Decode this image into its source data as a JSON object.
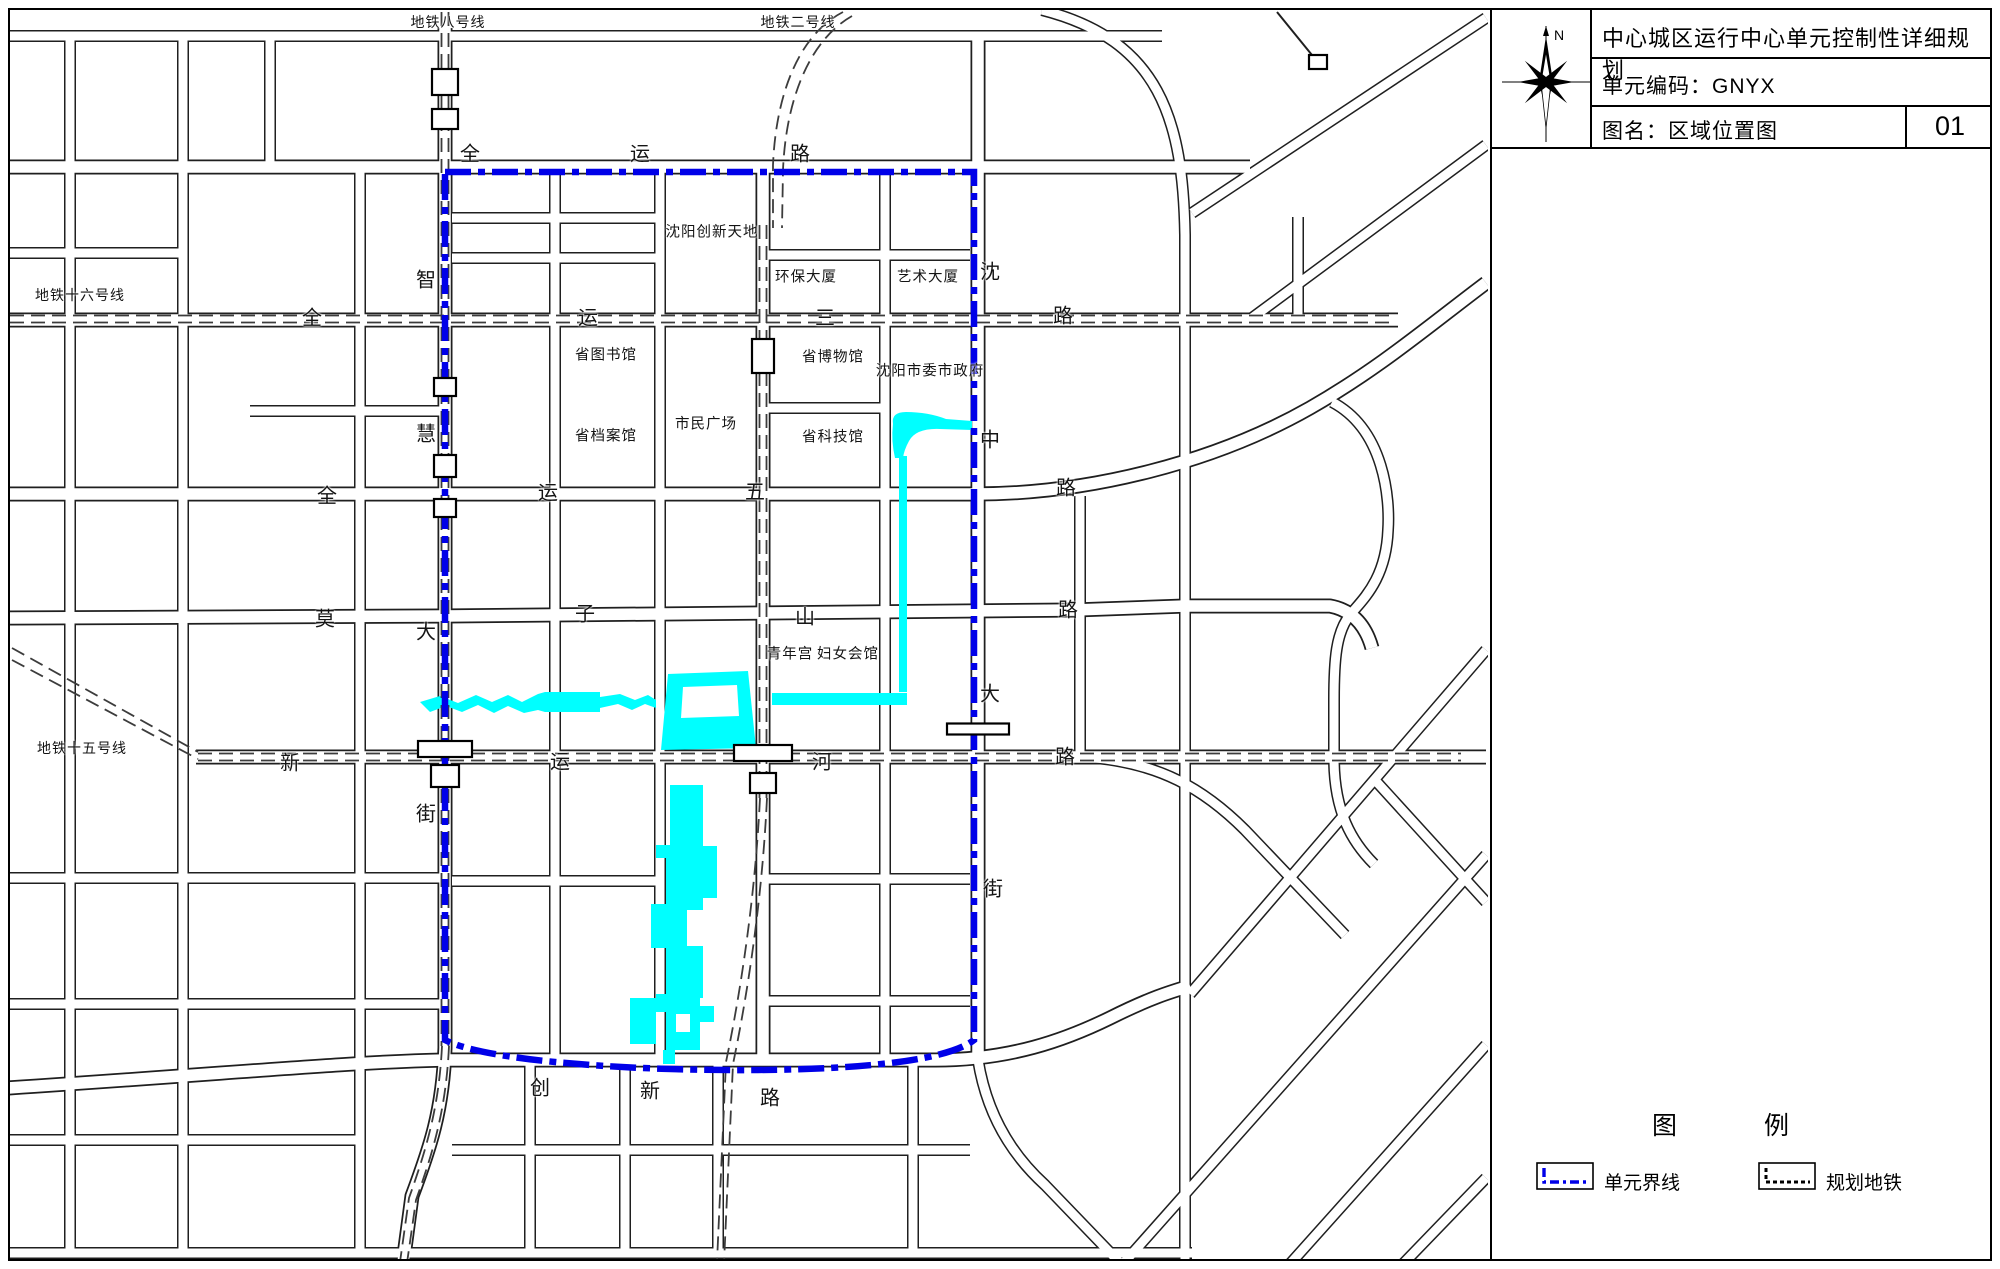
{
  "title_block": {
    "project_title": "中心城区运行中心单元控制性详细规划",
    "unit_code_line": "单元编码：GNYX",
    "map_name_line": "图名：区域位置图",
    "sheet_number": "01",
    "north_label": "N"
  },
  "legend": {
    "title_left": "图",
    "title_right": "例",
    "items": [
      {
        "label": "单元界线",
        "type": "unit-boundary"
      },
      {
        "label": "规划地铁",
        "type": "planned-metro"
      }
    ]
  },
  "colors": {
    "boundary_blue": "#0000E8",
    "water_cyan": "#00FFFF",
    "road_line": "#1f1f1f",
    "metro_dash": "#3c3c3c"
  },
  "map": {
    "metro_labels": [
      {
        "t": "地铁八号线",
        "x": 448,
        "y": 22
      },
      {
        "t": "地铁二号线",
        "x": 798,
        "y": 22
      },
      {
        "t": "地铁十六号线",
        "x": 80,
        "y": 295
      },
      {
        "t": "地铁十五号线",
        "x": 82,
        "y": 748
      }
    ],
    "road_chars": [
      {
        "t": "全",
        "x": 470,
        "y": 152
      },
      {
        "t": "运",
        "x": 640,
        "y": 152
      },
      {
        "t": "路",
        "x": 800,
        "y": 152
      },
      {
        "t": "全",
        "x": 312,
        "y": 316
      },
      {
        "t": "运",
        "x": 588,
        "y": 316
      },
      {
        "t": "三",
        "x": 825,
        "y": 316
      },
      {
        "t": "路",
        "x": 1063,
        "y": 314
      },
      {
        "t": "全",
        "x": 327,
        "y": 494
      },
      {
        "t": "运",
        "x": 548,
        "y": 491
      },
      {
        "t": "五",
        "x": 755,
        "y": 490
      },
      {
        "t": "路",
        "x": 1066,
        "y": 486
      },
      {
        "t": "莫",
        "x": 325,
        "y": 617
      },
      {
        "t": "子",
        "x": 585,
        "y": 612
      },
      {
        "t": "山",
        "x": 805,
        "y": 615
      },
      {
        "t": "路",
        "x": 1068,
        "y": 608
      },
      {
        "t": "新",
        "x": 290,
        "y": 761
      },
      {
        "t": "运",
        "x": 560,
        "y": 760
      },
      {
        "t": "河",
        "x": 822,
        "y": 760
      },
      {
        "t": "路",
        "x": 1065,
        "y": 755
      },
      {
        "t": "创",
        "x": 540,
        "y": 1086
      },
      {
        "t": "新",
        "x": 650,
        "y": 1089
      },
      {
        "t": "路",
        "x": 770,
        "y": 1096
      },
      {
        "t": "智",
        "x": 426,
        "y": 278
      },
      {
        "t": "慧",
        "x": 426,
        "y": 432
      },
      {
        "t": "大",
        "x": 426,
        "y": 630
      },
      {
        "t": "街",
        "x": 426,
        "y": 812
      },
      {
        "t": "沈",
        "x": 990,
        "y": 270
      },
      {
        "t": "中",
        "x": 990,
        "y": 438
      },
      {
        "t": "大",
        "x": 990,
        "y": 692
      },
      {
        "t": "街",
        "x": 993,
        "y": 887
      }
    ],
    "building_labels": [
      {
        "t": "沈阳创新天地",
        "x": 712,
        "y": 231
      },
      {
        "t": "环保大厦",
        "x": 806,
        "y": 276
      },
      {
        "t": "艺术大厦",
        "x": 928,
        "y": 276
      },
      {
        "t": "省图书馆",
        "x": 606,
        "y": 354
      },
      {
        "t": "省博物馆",
        "x": 833,
        "y": 356
      },
      {
        "t": "沈阳市委市政府",
        "x": 930,
        "y": 370
      },
      {
        "t": "市民广场",
        "x": 706,
        "y": 423
      },
      {
        "t": "省档案馆",
        "x": 606,
        "y": 435
      },
      {
        "t": "省科技馆",
        "x": 833,
        "y": 436
      },
      {
        "t": "青年宫",
        "x": 790,
        "y": 653
      },
      {
        "t": "妇女会馆",
        "x": 848,
        "y": 653
      }
    ]
  }
}
